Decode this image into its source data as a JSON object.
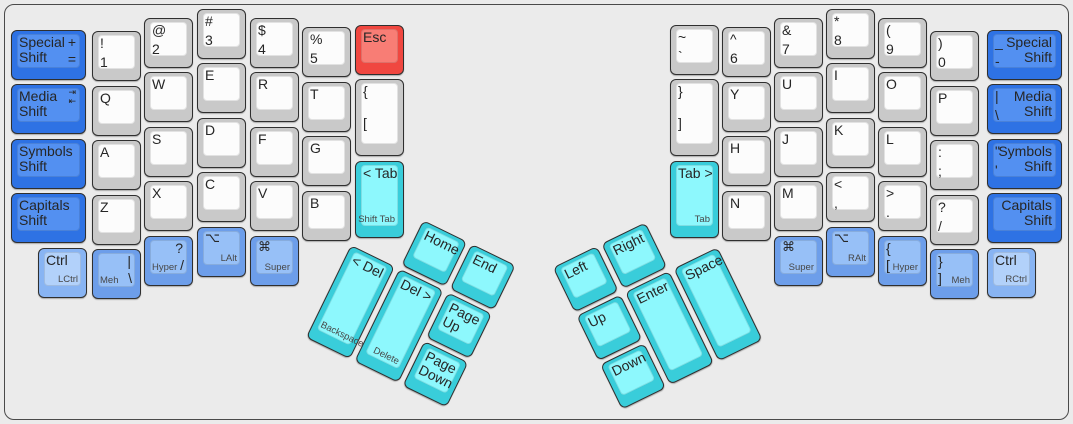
{
  "app": {
    "title": "Ergonomic split keyboard layout"
  },
  "colors": {
    "background": "#ebebeb",
    "frame_border": "#4a4a4a",
    "label": "#262626",
    "sublabel": "#474747",
    "palette": {
      "gray": {
        "base": "#c9c9c9",
        "top": "#fcfcfc"
      },
      "blue": {
        "base": "#2e72e4",
        "top": "#5390f1"
      },
      "mblue": {
        "base": "#6d9eea",
        "top": "#97c0f7"
      },
      "lblue": {
        "base": "#88b4f3",
        "top": "#b2d1fa"
      },
      "cyan": {
        "base": "#39cdda",
        "top": "#8df8fd"
      },
      "red": {
        "base": "#f04740",
        "top": "#f87d75"
      }
    }
  },
  "clusters": {
    "left": {
      "x": 351,
      "y": 245,
      "angle": 26
    },
    "right": {
      "x": 722,
      "y": 245,
      "angle": -26
    }
  },
  "keys": [
    {
      "n": "special-shift-left",
      "c": "blue",
      "x": 11,
      "y": 30,
      "w": 75,
      "h": 50,
      "l": [
        {
          "t": "Special\nShift",
          "p": "tl"
        },
        {
          "t": "+",
          "p": "tr"
        },
        {
          "t": "=",
          "p": "mr"
        }
      ]
    },
    {
      "n": "media-shift-left",
      "c": "blue",
      "x": 11,
      "y": 84,
      "w": 75,
      "h": 50,
      "l": [
        {
          "t": "Media\nShift",
          "p": "tl"
        },
        {
          "t": "⇥\n⇤",
          "p": "tr",
          "s": "icon"
        }
      ]
    },
    {
      "n": "symbols-shift-left",
      "c": "blue",
      "x": 11,
      "y": 139,
      "w": 75,
      "h": 50,
      "l": [
        {
          "t": "Symbols\nShift",
          "p": "tl"
        }
      ]
    },
    {
      "n": "capitals-shift-left",
      "c": "blue",
      "x": 11,
      "y": 193,
      "w": 75,
      "h": 50,
      "l": [
        {
          "t": "Capitals\nShift",
          "p": "tl"
        }
      ]
    },
    {
      "n": "key-1",
      "c": "gray",
      "x": 92,
      "y": 31,
      "w": 49,
      "h": 50,
      "l": [
        {
          "t": "!",
          "p": "tl"
        },
        {
          "t": "1",
          "p": "ml"
        }
      ]
    },
    {
      "n": "key-q",
      "c": "gray",
      "x": 92,
      "y": 86,
      "w": 49,
      "h": 50,
      "l": [
        {
          "t": "Q",
          "p": "tl"
        }
      ]
    },
    {
      "n": "key-a",
      "c": "gray",
      "x": 92,
      "y": 140,
      "w": 49,
      "h": 50,
      "l": [
        {
          "t": "A",
          "p": "tl"
        }
      ]
    },
    {
      "n": "key-z",
      "c": "gray",
      "x": 92,
      "y": 195,
      "w": 49,
      "h": 50,
      "l": [
        {
          "t": "Z",
          "p": "tl"
        }
      ]
    },
    {
      "n": "key-2",
      "c": "gray",
      "x": 144,
      "y": 18,
      "w": 49,
      "h": 50,
      "l": [
        {
          "t": "@",
          "p": "tl"
        },
        {
          "t": "2",
          "p": "ml"
        }
      ]
    },
    {
      "n": "key-w",
      "c": "gray",
      "x": 144,
      "y": 72,
      "w": 49,
      "h": 50,
      "l": [
        {
          "t": "W",
          "p": "tl"
        }
      ]
    },
    {
      "n": "key-s",
      "c": "gray",
      "x": 144,
      "y": 127,
      "w": 49,
      "h": 50,
      "l": [
        {
          "t": "S",
          "p": "tl"
        }
      ]
    },
    {
      "n": "key-x",
      "c": "gray",
      "x": 144,
      "y": 181,
      "w": 49,
      "h": 50,
      "l": [
        {
          "t": "X",
          "p": "tl"
        }
      ]
    },
    {
      "n": "key-3",
      "c": "gray",
      "x": 197,
      "y": 9,
      "w": 49,
      "h": 50,
      "l": [
        {
          "t": "#",
          "p": "tl"
        },
        {
          "t": "3",
          "p": "ml"
        }
      ]
    },
    {
      "n": "key-e",
      "c": "gray",
      "x": 197,
      "y": 63,
      "w": 49,
      "h": 50,
      "l": [
        {
          "t": "E",
          "p": "tl"
        }
      ]
    },
    {
      "n": "key-d",
      "c": "gray",
      "x": 197,
      "y": 118,
      "w": 49,
      "h": 50,
      "l": [
        {
          "t": "D",
          "p": "tl"
        }
      ]
    },
    {
      "n": "key-c",
      "c": "gray",
      "x": 197,
      "y": 172,
      "w": 49,
      "h": 50,
      "l": [
        {
          "t": "C",
          "p": "tl"
        }
      ]
    },
    {
      "n": "key-4",
      "c": "gray",
      "x": 250,
      "y": 18,
      "w": 49,
      "h": 50,
      "l": [
        {
          "t": "$",
          "p": "tl"
        },
        {
          "t": "4",
          "p": "ml"
        }
      ]
    },
    {
      "n": "key-r",
      "c": "gray",
      "x": 250,
      "y": 72,
      "w": 49,
      "h": 50,
      "l": [
        {
          "t": "R",
          "p": "tl"
        }
      ]
    },
    {
      "n": "key-f",
      "c": "gray",
      "x": 250,
      "y": 127,
      "w": 49,
      "h": 50,
      "l": [
        {
          "t": "F",
          "p": "tl"
        }
      ]
    },
    {
      "n": "key-v",
      "c": "gray",
      "x": 250,
      "y": 181,
      "w": 49,
      "h": 50,
      "l": [
        {
          "t": "V",
          "p": "tl"
        }
      ]
    },
    {
      "n": "key-5",
      "c": "gray",
      "x": 302,
      "y": 27,
      "w": 49,
      "h": 50,
      "l": [
        {
          "t": "%",
          "p": "tl"
        },
        {
          "t": "5",
          "p": "ml"
        }
      ]
    },
    {
      "n": "key-t",
      "c": "gray",
      "x": 302,
      "y": 82,
      "w": 49,
      "h": 50,
      "l": [
        {
          "t": "T",
          "p": "tl"
        }
      ]
    },
    {
      "n": "key-g",
      "c": "gray",
      "x": 302,
      "y": 136,
      "w": 49,
      "h": 50,
      "l": [
        {
          "t": "G",
          "p": "tl"
        }
      ]
    },
    {
      "n": "key-b",
      "c": "gray",
      "x": 302,
      "y": 191,
      "w": 49,
      "h": 50,
      "l": [
        {
          "t": "B",
          "p": "tl"
        }
      ]
    },
    {
      "n": "key-esc",
      "c": "red",
      "x": 355,
      "y": 25,
      "w": 49,
      "h": 50,
      "l": [
        {
          "t": "Esc",
          "p": "tl"
        }
      ]
    },
    {
      "n": "key-lbracket",
      "c": "gray",
      "x": 355,
      "y": 79,
      "w": 49,
      "h": 77,
      "l": [
        {
          "t": "{",
          "p": "tl"
        },
        {
          "t": "[",
          "p": "ml"
        }
      ]
    },
    {
      "n": "key-tab-left",
      "c": "cyan",
      "x": 355,
      "y": 161,
      "w": 49,
      "h": 77,
      "l": [
        {
          "t": "< Tab",
          "p": "tl"
        },
        {
          "t": "Shift Tab",
          "p": "br",
          "s": "s"
        }
      ]
    },
    {
      "n": "key-lctrl",
      "c": "lblue",
      "x": 38,
      "y": 248,
      "w": 49,
      "h": 50,
      "l": [
        {
          "t": "Ctrl",
          "p": "tl"
        },
        {
          "t": "LCtrl",
          "p": "br",
          "s": "s"
        }
      ]
    },
    {
      "n": "key-meh-left",
      "c": "mblue",
      "x": 92,
      "y": 249,
      "w": 49,
      "h": 50,
      "l": [
        {
          "t": "|",
          "p": "tr"
        },
        {
          "t": "Meh",
          "p": "bl",
          "s": "s"
        },
        {
          "t": "\\",
          "p": "br"
        }
      ]
    },
    {
      "n": "key-hyper-left",
      "c": "mblue",
      "x": 144,
      "y": 236,
      "w": 49,
      "h": 50,
      "l": [
        {
          "t": "?",
          "p": "tr"
        },
        {
          "t": "Hyper",
          "p": "bl",
          "s": "s"
        },
        {
          "t": "/",
          "p": "br"
        }
      ]
    },
    {
      "n": "key-lalt",
      "c": "mblue",
      "x": 197,
      "y": 227,
      "w": 49,
      "h": 50,
      "l": [
        {
          "t": "⌥",
          "p": "tl",
          "s": "g"
        },
        {
          "t": "LAlt",
          "p": "br",
          "s": "s"
        }
      ]
    },
    {
      "n": "key-super-left",
      "c": "mblue",
      "x": 250,
      "y": 236,
      "w": 49,
      "h": 50,
      "l": [
        {
          "t": "⌘",
          "p": "tl",
          "s": "g"
        },
        {
          "t": "Super",
          "p": "br",
          "s": "s"
        }
      ]
    },
    {
      "n": "key-home",
      "c": "cyan",
      "cl": "left",
      "x": 54,
      "y": -54,
      "w": 49,
      "h": 50,
      "l": [
        {
          "t": "Home",
          "p": "tl"
        }
      ]
    },
    {
      "n": "key-end",
      "c": "cyan",
      "cl": "left",
      "x": 108,
      "y": -54,
      "w": 49,
      "h": 50,
      "l": [
        {
          "t": "End",
          "p": "tl"
        }
      ]
    },
    {
      "n": "key-backspace",
      "c": "cyan",
      "cl": "left",
      "x": 0,
      "y": 0,
      "w": 49,
      "h": 103,
      "l": [
        {
          "t": "< Del",
          "p": "tl"
        },
        {
          "t": "Backspace",
          "p": "bl",
          "s": "s"
        }
      ]
    },
    {
      "n": "key-delete",
      "c": "cyan",
      "cl": "left",
      "x": 54,
      "y": 0,
      "w": 49,
      "h": 103,
      "l": [
        {
          "t": "Del >",
          "p": "tl"
        },
        {
          "t": "Delete",
          "p": "br",
          "s": "s"
        }
      ]
    },
    {
      "n": "key-page-up",
      "c": "cyan",
      "cl": "left",
      "x": 108,
      "y": 0,
      "w": 49,
      "h": 50,
      "l": [
        {
          "t": "Page\nUp",
          "p": "tl"
        }
      ]
    },
    {
      "n": "key-page-down",
      "c": "cyan",
      "cl": "left",
      "x": 108,
      "y": 54,
      "w": 49,
      "h": 50,
      "l": [
        {
          "t": "Page\nDown",
          "p": "tl"
        }
      ]
    },
    {
      "n": "key-left",
      "c": "cyan",
      "cl": "right",
      "x": -162,
      "y": -54,
      "w": 49,
      "h": 50,
      "l": [
        {
          "t": "Left",
          "p": "tl"
        }
      ]
    },
    {
      "n": "key-right",
      "c": "cyan",
      "cl": "right",
      "x": -108,
      "y": -54,
      "w": 49,
      "h": 50,
      "l": [
        {
          "t": "Right",
          "p": "tl"
        }
      ]
    },
    {
      "n": "key-up",
      "c": "cyan",
      "cl": "right",
      "x": -162,
      "y": 0,
      "w": 49,
      "h": 50,
      "l": [
        {
          "t": "Up",
          "p": "tl"
        }
      ]
    },
    {
      "n": "key-down",
      "c": "cyan",
      "cl": "right",
      "x": -162,
      "y": 54,
      "w": 49,
      "h": 50,
      "l": [
        {
          "t": "Down",
          "p": "tl"
        }
      ]
    },
    {
      "n": "key-enter",
      "c": "cyan",
      "cl": "right",
      "x": -108,
      "y": 0,
      "w": 49,
      "h": 103,
      "l": [
        {
          "t": "Enter",
          "p": "tl"
        }
      ]
    },
    {
      "n": "key-space",
      "c": "cyan",
      "cl": "right",
      "x": -54,
      "y": 0,
      "w": 49,
      "h": 103,
      "l": [
        {
          "t": "Space",
          "p": "tl"
        }
      ]
    },
    {
      "n": "key-tilde",
      "c": "gray",
      "x": 670,
      "y": 25,
      "w": 49,
      "h": 50,
      "l": [
        {
          "t": "~",
          "p": "tl"
        },
        {
          "t": "`",
          "p": "ml"
        }
      ]
    },
    {
      "n": "key-rbrace",
      "c": "gray",
      "x": 670,
      "y": 79,
      "w": 49,
      "h": 77,
      "l": [
        {
          "t": "}",
          "p": "tl"
        },
        {
          "t": "]",
          "p": "ml"
        }
      ]
    },
    {
      "n": "key-tab-right",
      "c": "cyan",
      "x": 670,
      "y": 161,
      "w": 49,
      "h": 77,
      "l": [
        {
          "t": "Tab >",
          "p": "tl"
        },
        {
          "t": "Tab",
          "p": "br",
          "s": "s"
        }
      ]
    },
    {
      "n": "key-6",
      "c": "gray",
      "x": 722,
      "y": 27,
      "w": 49,
      "h": 50,
      "l": [
        {
          "t": "^",
          "p": "tl"
        },
        {
          "t": "6",
          "p": "ml"
        }
      ]
    },
    {
      "n": "key-y",
      "c": "gray",
      "x": 722,
      "y": 82,
      "w": 49,
      "h": 50,
      "l": [
        {
          "t": "Y",
          "p": "tl"
        }
      ]
    },
    {
      "n": "key-h",
      "c": "gray",
      "x": 722,
      "y": 136,
      "w": 49,
      "h": 50,
      "l": [
        {
          "t": "H",
          "p": "tl"
        }
      ]
    },
    {
      "n": "key-n",
      "c": "gray",
      "x": 722,
      "y": 191,
      "w": 49,
      "h": 50,
      "l": [
        {
          "t": "N",
          "p": "tl"
        }
      ]
    },
    {
      "n": "key-7",
      "c": "gray",
      "x": 774,
      "y": 18,
      "w": 49,
      "h": 50,
      "l": [
        {
          "t": "&",
          "p": "tl"
        },
        {
          "t": "7",
          "p": "ml"
        }
      ]
    },
    {
      "n": "key-u",
      "c": "gray",
      "x": 774,
      "y": 72,
      "w": 49,
      "h": 50,
      "l": [
        {
          "t": "U",
          "p": "tl"
        }
      ]
    },
    {
      "n": "key-j",
      "c": "gray",
      "x": 774,
      "y": 127,
      "w": 49,
      "h": 50,
      "l": [
        {
          "t": "J",
          "p": "tl"
        }
      ]
    },
    {
      "n": "key-m",
      "c": "gray",
      "x": 774,
      "y": 181,
      "w": 49,
      "h": 50,
      "l": [
        {
          "t": "M",
          "p": "tl"
        }
      ]
    },
    {
      "n": "key-8",
      "c": "gray",
      "x": 826,
      "y": 9,
      "w": 49,
      "h": 50,
      "l": [
        {
          "t": "*",
          "p": "tl"
        },
        {
          "t": "8",
          "p": "ml"
        }
      ]
    },
    {
      "n": "key-i",
      "c": "gray",
      "x": 826,
      "y": 63,
      "w": 49,
      "h": 50,
      "l": [
        {
          "t": "I",
          "p": "tl"
        }
      ]
    },
    {
      "n": "key-k",
      "c": "gray",
      "x": 826,
      "y": 118,
      "w": 49,
      "h": 50,
      "l": [
        {
          "t": "K",
          "p": "tl"
        }
      ]
    },
    {
      "n": "key-comma",
      "c": "gray",
      "x": 826,
      "y": 172,
      "w": 49,
      "h": 50,
      "l": [
        {
          "t": "<",
          "p": "tl"
        },
        {
          "t": ",",
          "p": "ml"
        }
      ]
    },
    {
      "n": "key-9",
      "c": "gray",
      "x": 878,
      "y": 18,
      "w": 49,
      "h": 50,
      "l": [
        {
          "t": "(",
          "p": "tl"
        },
        {
          "t": "9",
          "p": "ml"
        }
      ]
    },
    {
      "n": "key-o",
      "c": "gray",
      "x": 878,
      "y": 72,
      "w": 49,
      "h": 50,
      "l": [
        {
          "t": "O",
          "p": "tl"
        }
      ]
    },
    {
      "n": "key-l",
      "c": "gray",
      "x": 878,
      "y": 127,
      "w": 49,
      "h": 50,
      "l": [
        {
          "t": "L",
          "p": "tl"
        }
      ]
    },
    {
      "n": "key-period",
      "c": "gray",
      "x": 878,
      "y": 181,
      "w": 49,
      "h": 50,
      "l": [
        {
          "t": ">",
          "p": "tl"
        },
        {
          "t": ".",
          "p": "ml"
        }
      ]
    },
    {
      "n": "key-0",
      "c": "gray",
      "x": 930,
      "y": 31,
      "w": 49,
      "h": 50,
      "l": [
        {
          "t": ")",
          "p": "tl"
        },
        {
          "t": "0",
          "p": "ml"
        }
      ]
    },
    {
      "n": "key-p",
      "c": "gray",
      "x": 930,
      "y": 86,
      "w": 49,
      "h": 50,
      "l": [
        {
          "t": "P",
          "p": "tl"
        }
      ]
    },
    {
      "n": "key-semicolon",
      "c": "gray",
      "x": 930,
      "y": 140,
      "w": 49,
      "h": 50,
      "l": [
        {
          "t": ":",
          "p": "tl"
        },
        {
          "t": ";",
          "p": "ml"
        }
      ]
    },
    {
      "n": "key-slash",
      "c": "gray",
      "x": 930,
      "y": 195,
      "w": 49,
      "h": 50,
      "l": [
        {
          "t": "?",
          "p": "tl"
        },
        {
          "t": "/",
          "p": "ml"
        }
      ]
    },
    {
      "n": "special-shift-right",
      "c": "blue",
      "x": 987,
      "y": 30,
      "w": 75,
      "h": 50,
      "l": [
        {
          "t": "Special\nShift",
          "p": "trm"
        },
        {
          "t": "_",
          "p": "tl"
        },
        {
          "t": "-",
          "p": "ml"
        }
      ]
    },
    {
      "n": "media-shift-right",
      "c": "blue",
      "x": 987,
      "y": 84,
      "w": 75,
      "h": 50,
      "l": [
        {
          "t": "Media\nShift",
          "p": "trm"
        },
        {
          "t": "|",
          "p": "tl"
        },
        {
          "t": "\\",
          "p": "ml"
        }
      ]
    },
    {
      "n": "symbols-shift-right",
      "c": "blue",
      "x": 987,
      "y": 139,
      "w": 75,
      "h": 50,
      "l": [
        {
          "t": "Symbols\nShift",
          "p": "trm"
        },
        {
          "t": "\"",
          "p": "tl"
        },
        {
          "t": "'",
          "p": "ml"
        }
      ]
    },
    {
      "n": "capitals-shift-right",
      "c": "blue",
      "x": 987,
      "y": 193,
      "w": 75,
      "h": 50,
      "l": [
        {
          "t": "Capitals\nShift",
          "p": "trm"
        }
      ]
    },
    {
      "n": "key-super-right",
      "c": "mblue",
      "x": 774,
      "y": 236,
      "w": 49,
      "h": 50,
      "l": [
        {
          "t": "⌘",
          "p": "tl",
          "s": "g"
        },
        {
          "t": "Super",
          "p": "br",
          "s": "s"
        }
      ]
    },
    {
      "n": "key-ralt",
      "c": "mblue",
      "x": 826,
      "y": 227,
      "w": 49,
      "h": 50,
      "l": [
        {
          "t": "⌥",
          "p": "tl",
          "s": "g"
        },
        {
          "t": "RAlt",
          "p": "br",
          "s": "s"
        }
      ]
    },
    {
      "n": "key-hyper-right",
      "c": "mblue",
      "x": 878,
      "y": 236,
      "w": 49,
      "h": 50,
      "l": [
        {
          "t": "{",
          "p": "tl"
        },
        {
          "t": "[",
          "p": "bl"
        },
        {
          "t": "Hyper",
          "p": "br",
          "s": "s"
        }
      ]
    },
    {
      "n": "key-meh-right",
      "c": "mblue",
      "x": 930,
      "y": 249,
      "w": 49,
      "h": 50,
      "l": [
        {
          "t": "}",
          "p": "tl"
        },
        {
          "t": "]",
          "p": "bl"
        },
        {
          "t": "Meh",
          "p": "br",
          "s": "s"
        }
      ]
    },
    {
      "n": "key-rctrl",
      "c": "lblue",
      "x": 987,
      "y": 248,
      "w": 49,
      "h": 50,
      "l": [
        {
          "t": "Ctrl",
          "p": "tl"
        },
        {
          "t": "RCtrl",
          "p": "br",
          "s": "s"
        }
      ]
    }
  ]
}
